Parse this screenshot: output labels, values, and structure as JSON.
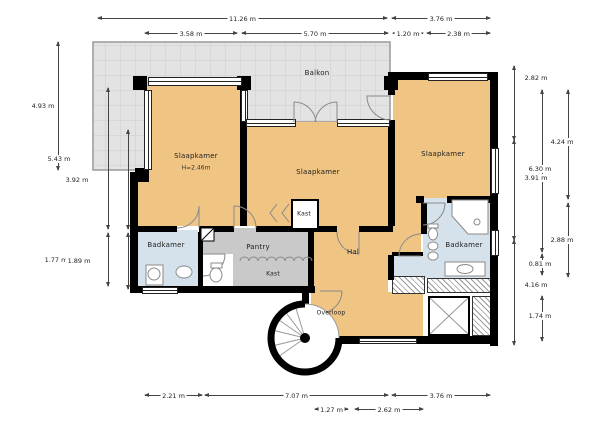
{
  "plan": {
    "type": "floorplan",
    "language": "nl",
    "colors": {
      "room_orange": "#f0c482",
      "room_gray": "#c9c9c9",
      "room_blue": "#d5e2eb",
      "balcony_gray": "#e3e3e3",
      "wall_black": "#000000"
    },
    "rooms": [
      {
        "id": "balkon",
        "label": "Balkon",
        "x": 317,
        "y": 73
      },
      {
        "id": "slaapkamer-left",
        "label": "Slaapkamer",
        "sub": "H=2.46m",
        "x": 196,
        "y": 156,
        "subY": 168
      },
      {
        "id": "slaapkamer-middle",
        "label": "Slaapkamer",
        "x": 318,
        "y": 172
      },
      {
        "id": "slaapkamer-right",
        "label": "Slaapkamer",
        "x": 443,
        "y": 154
      },
      {
        "id": "kast-middle",
        "label": "Kast",
        "x": 304,
        "y": 214,
        "small": true
      },
      {
        "id": "badkamer-left",
        "label": "Badkamer",
        "x": 166,
        "y": 245
      },
      {
        "id": "pantry",
        "label": "Pantry",
        "x": 258,
        "y": 247
      },
      {
        "id": "kast-bottom",
        "label": "Kast",
        "x": 273,
        "y": 274,
        "small": true
      },
      {
        "id": "hal",
        "label": "Hal",
        "x": 353,
        "y": 252
      },
      {
        "id": "badkamer-right",
        "label": "Badkamer",
        "x": 464,
        "y": 245
      },
      {
        "id": "overloop",
        "label": "Overloop",
        "x": 331,
        "y": 313,
        "small": true
      }
    ],
    "dimensions": [
      {
        "label": "11.26 m",
        "orient": "h",
        "x": 98,
        "y": 18,
        "len": 289
      },
      {
        "label": "3.76 m",
        "orient": "h",
        "x": 392,
        "y": 18,
        "len": 98
      },
      {
        "label": "3.58 m",
        "orient": "h",
        "x": 145,
        "y": 33,
        "len": 92
      },
      {
        "label": "5.70 m",
        "orient": "h",
        "x": 242,
        "y": 33,
        "len": 146
      },
      {
        "label": "1.20 m",
        "orient": "h",
        "x": 393,
        "y": 33,
        "len": 30
      },
      {
        "label": "2.38 m",
        "orient": "h",
        "x": 427,
        "y": 33,
        "len": 63
      },
      {
        "label": "4.93 m",
        "orient": "v",
        "x": 58,
        "y": 42,
        "len": 128,
        "lx": 43
      },
      {
        "label": "5.43 m",
        "orient": "v",
        "x": 108,
        "y": 88,
        "len": 141,
        "lx": 59
      },
      {
        "label": "1.77 m",
        "orient": "v",
        "x": 108,
        "y": 233,
        "len": 53,
        "lx": 56
      },
      {
        "label": "3.92 m",
        "orient": "v",
        "x": 128,
        "y": 130,
        "len": 99,
        "lx": 77
      },
      {
        "label": "1.89 m",
        "orient": "v",
        "x": 128,
        "y": 233,
        "len": 56,
        "lx": 79
      },
      {
        "label": "2.82 m",
        "orient": "v",
        "x": 514,
        "y": 66,
        "len": 74,
        "lx": 536,
        "ly": 78
      },
      {
        "label": "3.91 m",
        "orient": "v",
        "x": 514,
        "y": 140,
        "len": 100,
        "lx": 536,
        "ly": 178
      },
      {
        "label": "4.16 m",
        "orient": "v",
        "x": 514,
        "y": 240,
        "len": 105,
        "lx": 536,
        "ly": 285
      },
      {
        "label": "6.30 m",
        "orient": "v",
        "x": 542,
        "y": 90,
        "len": 162,
        "lx": 540,
        "ly": 169
      },
      {
        "label": "0.81 m",
        "orient": "v",
        "x": 542,
        "y": 254,
        "len": 21,
        "lx": 540,
        "ly": 264
      },
      {
        "label": "1.74 m",
        "orient": "v",
        "x": 542,
        "y": 296,
        "len": 45,
        "lx": 540,
        "ly": 316
      },
      {
        "label": "4.24 m",
        "orient": "v",
        "x": 568,
        "y": 90,
        "len": 109,
        "lx": 562,
        "ly": 142
      },
      {
        "label": "2.88 m",
        "orient": "v",
        "x": 568,
        "y": 203,
        "len": 74,
        "lx": 562,
        "ly": 240
      },
      {
        "label": "2.21 m",
        "orient": "h",
        "x": 145,
        "y": 395,
        "len": 57
      },
      {
        "label": "7.07 m",
        "orient": "h",
        "x": 205,
        "y": 395,
        "len": 183
      },
      {
        "label": "3.76 m",
        "orient": "h",
        "x": 392,
        "y": 395,
        "len": 98
      },
      {
        "label": "1.27 m",
        "orient": "h",
        "x": 315,
        "y": 409,
        "len": 33
      },
      {
        "label": "2.62 m",
        "orient": "h",
        "x": 355,
        "y": 409,
        "len": 68
      }
    ]
  }
}
